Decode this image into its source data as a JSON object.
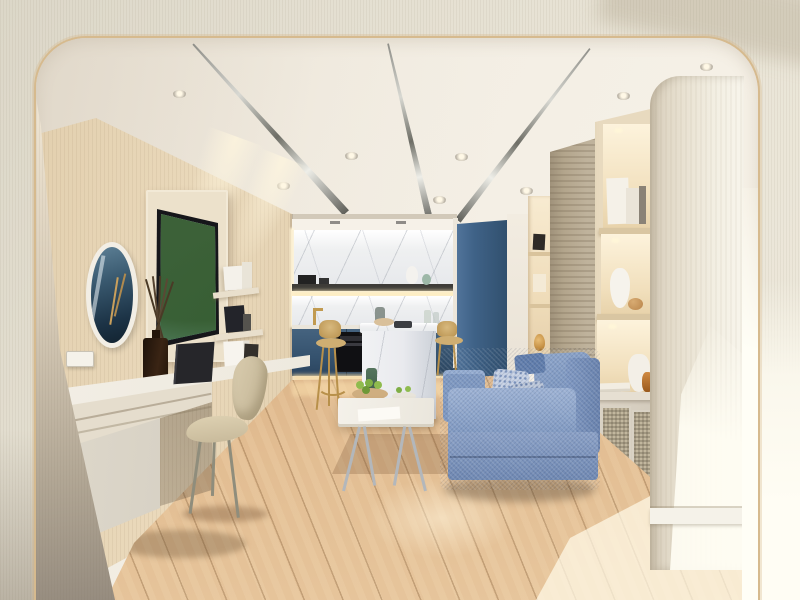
{
  "scene": {
    "type": "interior-architectural-render",
    "description": "Photorealistic render of a modern apartment living room with open kitchenette, seen through a rounded-corner archway",
    "visible_text": "none",
    "lighting": "warm recessed ceiling spotlights, cove lighting, sunlight from the right"
  },
  "palette": {
    "archway_wall": "#e4dfd1",
    "arch_trim": "#d6ba8e",
    "ceiling": "#f2ece2",
    "chrome_strip": "#c9c9c3",
    "wood_wall": "#dcc8a8",
    "kitchen_cabinet_blue": "#35526e",
    "tall_cabinet_blue": "#3f6287",
    "marble_backsplash": "#eff0f1",
    "island_marble": "#f0f1f3",
    "sofa_fabric_blue": "#7e9ac4",
    "pillow_pattern_blue": "#c6d1e4",
    "travertine_wall": "#b3a58c",
    "shelf_wood": "#e8dabf",
    "pillar_wood": "#efe9dc",
    "floor_oak": "#d9b084",
    "stool_gold": "#c9a35c",
    "chair_beige": "#cdc0a2",
    "desk_white_oak": "#e9e2d4",
    "tv_frame": "#16161a",
    "tv_pool_water": "#3fa9cf",
    "diffuser_amber_glass": "#2e1d12",
    "sunlight": "#fffdf4",
    "apples_green": "#8fbb4e"
  },
  "regions": {
    "archway": {
      "shape": "rounded rectangle opening",
      "corner_radius_px": 50,
      "trim": "thin tan line"
    },
    "ceiling": {
      "chrome_strips": 3,
      "recessed_spotlights": 8
    },
    "left_wall": {
      "finish": "light oak paneling",
      "objects": [
        "round-mirror",
        "wall-mounted-tv",
        "reed-diffuser",
        "wall-shelves-with-books",
        "white-speaker-box",
        "black-devices",
        "light-switch",
        "white-desk-console",
        "beige-molded-chair",
        "dark-laptop",
        "white-books"
      ]
    },
    "kitchen": {
      "objects": [
        "marble-backsplash",
        "lit-display-shelf",
        "coffee-machine",
        "white-vase",
        "green-vase",
        "gold-faucet",
        "glass-bottles",
        "blue-base-cabinets",
        "built-in-oven",
        "toe-kick-light",
        "tall-blue-cabinet",
        "marble-waterfall-island",
        "serving-bowl",
        "dark-tray",
        "gold-bar-stool-left",
        "gold-bar-stool-right"
      ]
    },
    "lounge": {
      "objects": [
        "blue-fabric-sofa",
        "patterned-pillows",
        "white-coffee-table",
        "bowl-of-green-apples",
        "green-glass-bottle",
        "small-plate",
        "white-card"
      ]
    },
    "right_wall": {
      "objects": [
        "narrow-lit-niche",
        "framed-photo",
        "gold-teardrop-ornament",
        "travertine-feature-strip",
        "built-in-shelving-unit",
        "white-books",
        "white-vases",
        "wood-sphere",
        "amber-bottle",
        "radiator-cover-with-mesh",
        "book-stack",
        "rounded-white-pillar",
        "sunlit-wall-patch"
      ]
    },
    "floor": {
      "finish": "diagonal light-oak planks",
      "features": [
        "sunlight-pool-center",
        "bright-sun-patch-right",
        "shadow-inlay-under-table"
      ]
    },
    "tv_screen_shows": "tropical pool terrace with green trees, water and wooden deck"
  }
}
